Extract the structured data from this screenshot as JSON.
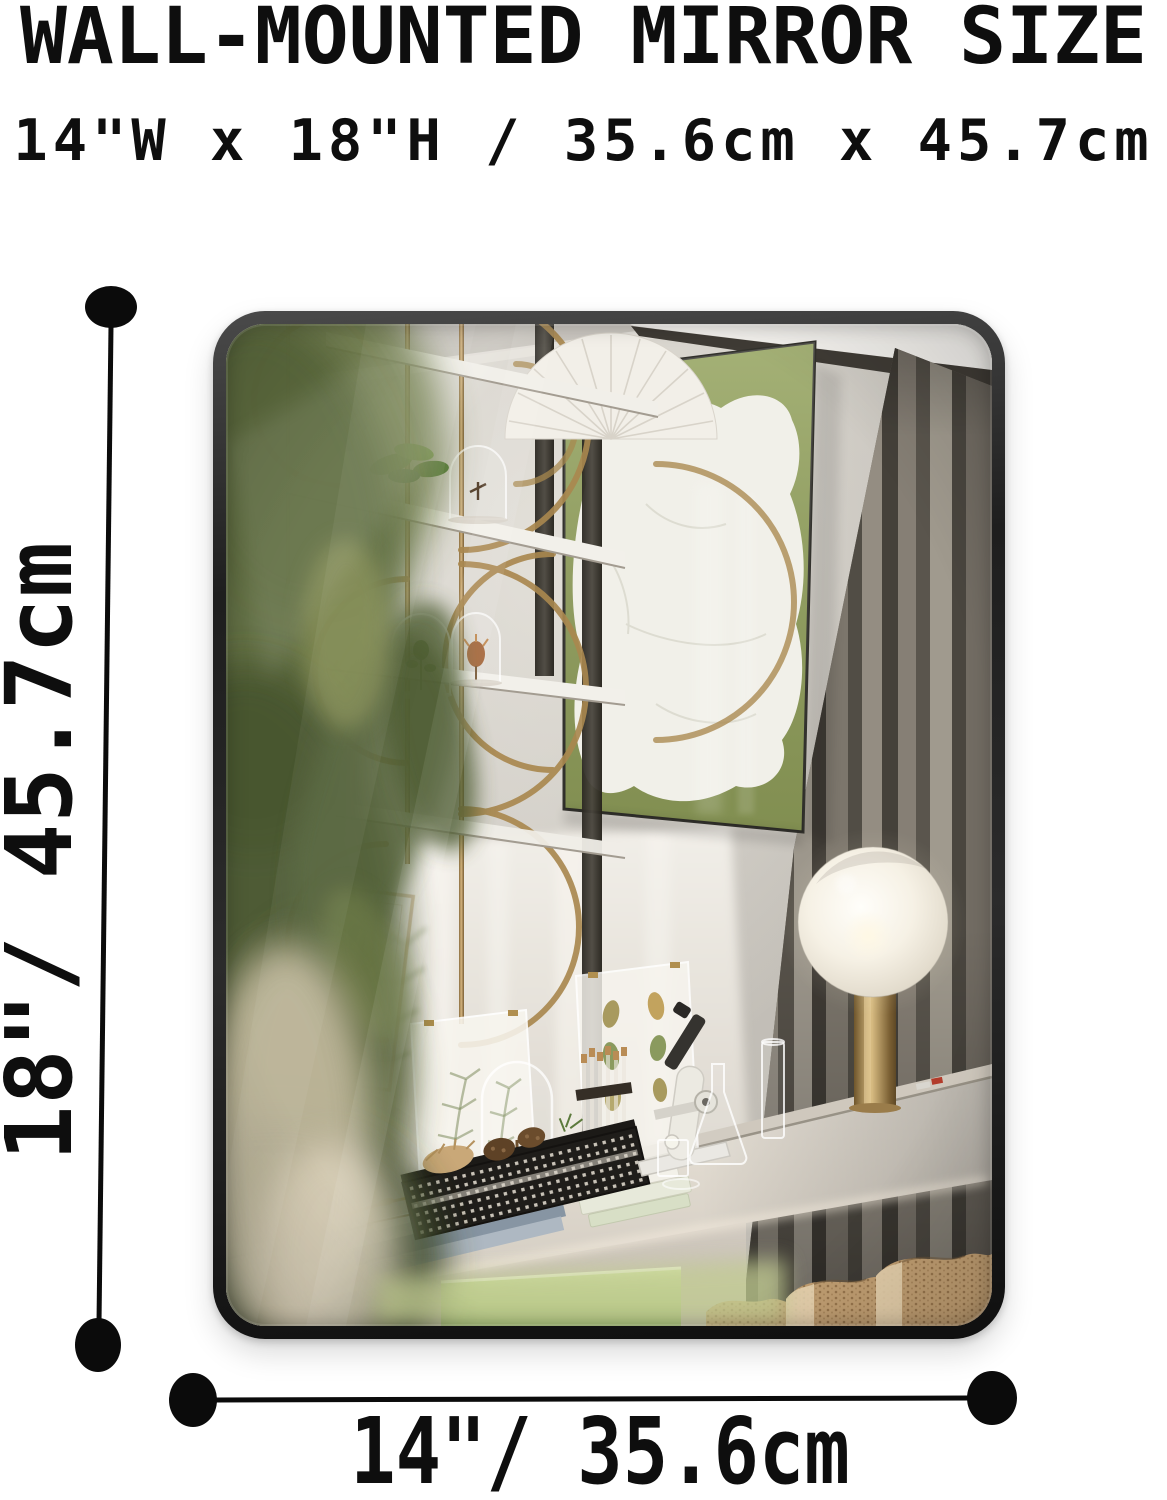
{
  "product_image": {
    "title": "WALL-MOUNTED MIRROR SIZE",
    "size_summary": "14\"W x 18\"H / 35.6cm x 45.7cm",
    "height_label": "18\"/ 45.7cm",
    "width_label": "14\"/ 35.6cm"
  },
  "palette": {
    "ink": "#0e0e0e",
    "frame": "#1e1e1e",
    "wall": "#c7c3bc",
    "curtain": "#6b665d",
    "art_green": "#93a25c",
    "brass": "#a9884f",
    "lamp_glow": "#fdf8ea",
    "box_green": "#aecb7e",
    "stool_tan": "#c2a176",
    "foliage": "#55643a"
  }
}
